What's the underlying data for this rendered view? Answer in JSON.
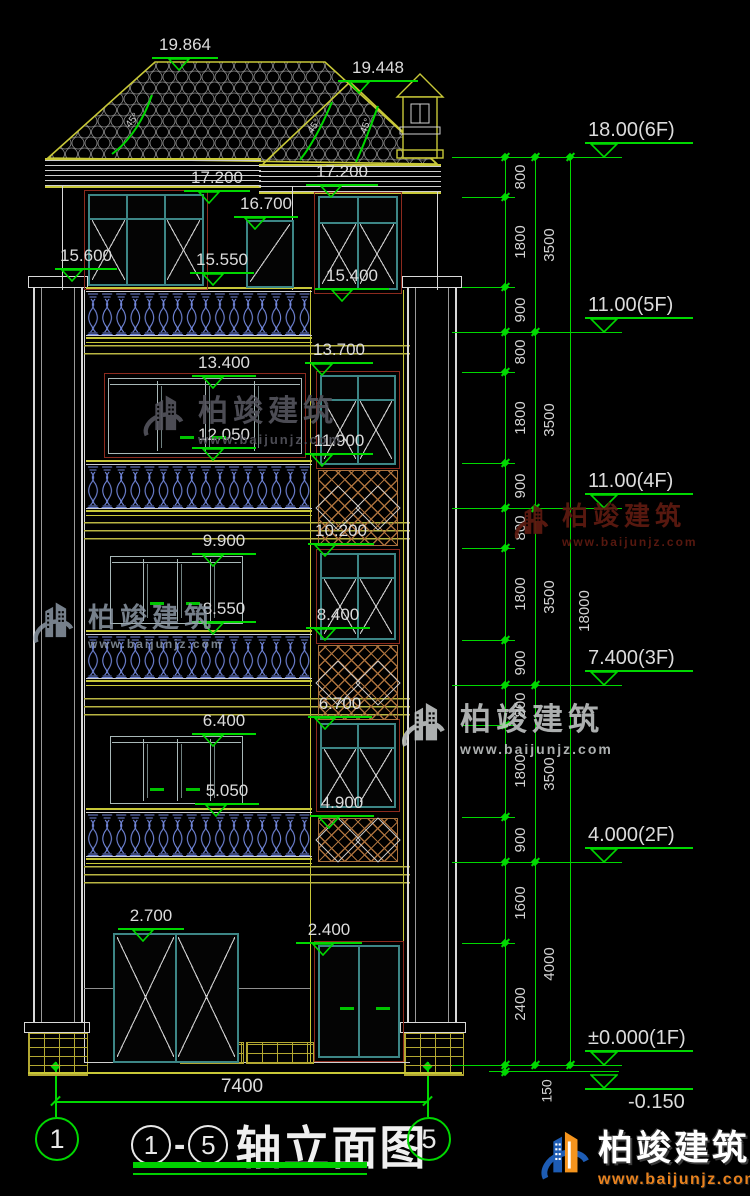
{
  "drawing": {
    "title": {
      "axis_start": "1",
      "dash": "-",
      "axis_end": "5",
      "name": "轴立面图"
    },
    "grid_bubbles": {
      "left": "1",
      "right": "5"
    }
  },
  "elevation_marks": [
    "19.864",
    "19.448",
    "17.200",
    "17.200",
    "16.700",
    "15.600",
    "15.550",
    "15.400",
    "13.400",
    "13.700",
    "12.050",
    "11.900",
    "10.200",
    "9.900",
    "8.550",
    "8.400",
    "6.700",
    "6.400",
    "5.050",
    "4.900",
    "2.700",
    "2.400"
  ],
  "levels": [
    "18.00(6F)",
    "11.00(5F)",
    "11.00(4F)",
    "7.400(3F)",
    "4.000(2F)",
    "±0.000(1F)",
    "-0.150"
  ],
  "dims": {
    "inner_chain": [
      "800",
      "1800",
      "900",
      "800",
      "1800",
      "900",
      "800",
      "1800",
      "900",
      "800",
      "1800",
      "900",
      "1600",
      "2400"
    ],
    "offset": "150",
    "floor_chain": [
      "3500",
      "3500",
      "3500",
      "3500",
      "4000"
    ],
    "overall": "18000",
    "width": "7400"
  },
  "angle_marks": [
    "45°",
    "45°",
    "45°"
  ],
  "watermark": {
    "name": "柏竣建筑",
    "url": "www.baijunjz.com"
  },
  "colors": {
    "background": "#000000",
    "line_green": "#00d800",
    "line_yellow": "#c8c838",
    "line_white": "#d9d9d9",
    "window_teal": "#3d8686",
    "frame_maroon": "#8c2a1e",
    "baluster_blue": "#7388dd",
    "lattice_orange": "#a9703c",
    "brand_blue": "#1d5cb4",
    "brand_orange": "#f5941d"
  }
}
